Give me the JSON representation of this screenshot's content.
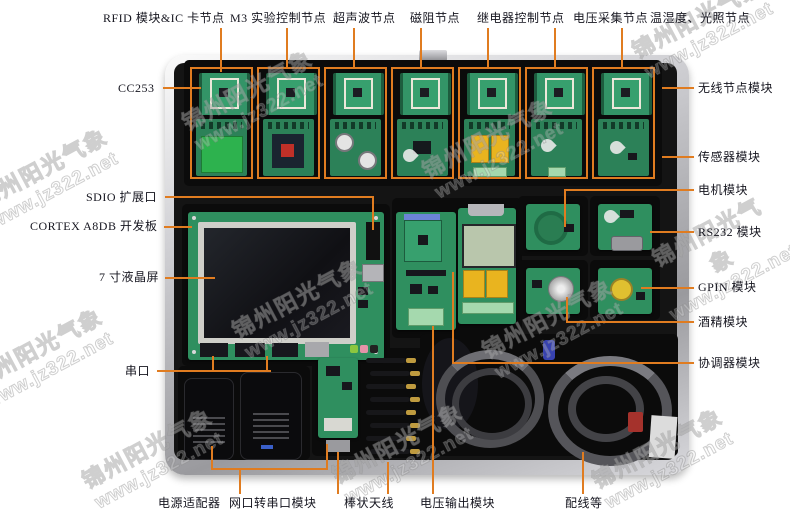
{
  "watermark": {
    "line1": "锦州阳光气象",
    "line2": "www.jz322.net"
  },
  "colors": {
    "annotation_line": "#e07c20",
    "label_text": "#15151f",
    "pcb_green": "#2f8f5f",
    "case_silver": "#c9c9cd",
    "foam_black": "#141414",
    "relay_yellow": "#e9b41f"
  },
  "labels": {
    "top": [
      {
        "text": "RFID 模块&IC 卡节点"
      },
      {
        "text": "M3 实验控制节点"
      },
      {
        "text": "超声波节点"
      },
      {
        "text": "磁阻节点"
      },
      {
        "text": "继电器控制节点"
      },
      {
        "text": "电压采集节点"
      },
      {
        "text": "温湿度、光照节点"
      }
    ],
    "left": [
      {
        "text": "CC253"
      },
      {
        "text": "SDIO 扩展口"
      },
      {
        "text": "CORTEX A8DB 开发板"
      },
      {
        "text": "7 寸液晶屏"
      },
      {
        "text": "串口"
      }
    ],
    "right": [
      {
        "text": "无线节点模块"
      },
      {
        "text": "传感器模块"
      },
      {
        "text": "电机模块"
      },
      {
        "text": "RS232 模块"
      },
      {
        "text": "GPIN 模块"
      },
      {
        "text": "酒精模块"
      },
      {
        "text": "协调器模块"
      }
    ],
    "bottom": [
      {
        "text": "电源适配器"
      },
      {
        "text": "网口转串口模块"
      },
      {
        "text": "棒状天线"
      },
      {
        "text": "电压输出模块"
      },
      {
        "text": "配线等"
      }
    ]
  }
}
